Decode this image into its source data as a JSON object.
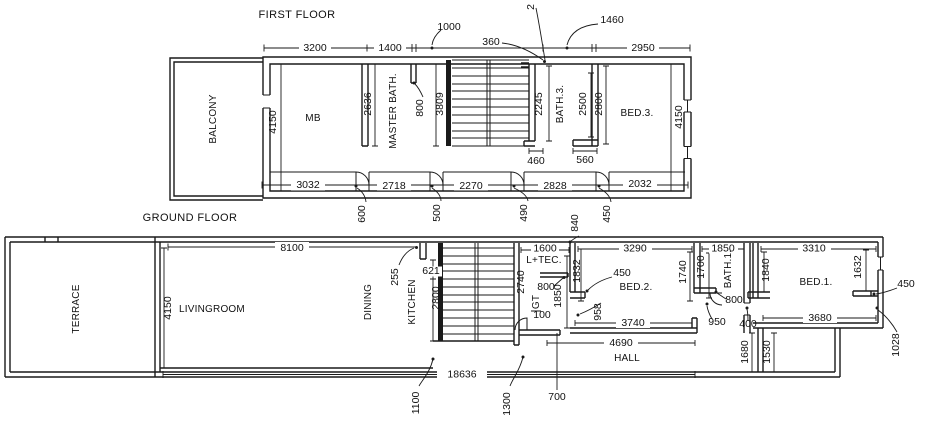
{
  "colors": {
    "line": "#1a1a1a",
    "background": "#ffffff"
  },
  "titles": {
    "first_floor": "FIRST FLOOR",
    "ground_floor": "GROUND FLOOR"
  },
  "first_floor": {
    "rooms": {
      "balcony": "BALCONY",
      "mb": "MB",
      "master_bath": "MASTER BATH.",
      "bath3": "BATH.3.",
      "bed3": "BED.3."
    },
    "dims": {
      "top_3200": "3200",
      "top_1400": "1400",
      "top_2950": "2950",
      "leader_1000": "1000",
      "leader_360": "360",
      "leader_1460": "1460",
      "leader_partial": "2",
      "left_4150": "4150",
      "mb_2636": "2636",
      "stub_800": "800",
      "stair_3809": "3809",
      "stair_2245": "2245",
      "bath3_2500": "2500",
      "bed3_2800": "2800",
      "right_4150": "4150",
      "bottom_3032": "3032",
      "bottom_2718": "2718",
      "bottom_2270": "2270",
      "bottom_2828": "2828",
      "bottom_2032": "2032",
      "door_460": "460",
      "door_560": "560",
      "below_600": "600",
      "below_500": "500",
      "below_490": "490",
      "below_840": "840",
      "below_450": "450"
    }
  },
  "ground_floor": {
    "rooms": {
      "terrace": "TERRACE",
      "livingroom": "LIVINGROOM",
      "dining": "DINING",
      "kitchen": "KITCHEN",
      "ltec": "L+TEC.",
      "gt": "GT",
      "bed2": "BED.2.",
      "bath1": "BATH.1.",
      "bed1": "BED.1.",
      "hall": "HALL"
    },
    "dims": {
      "living_8100": "8100",
      "living_4150": "4150",
      "leader_255": "255",
      "kitchen_621": "621",
      "kitchen_2800": "2800",
      "stair_2740": "2740",
      "ltec_1600": "1600",
      "ltec_800": "800",
      "ltec_1850": "1850",
      "ltec_1832": "1832",
      "gt_100": "100",
      "bed2_3290": "3290",
      "bed2_450": "450",
      "bed2_1740": "1740",
      "bed2_958": "958",
      "hall_3740": "3740",
      "hall_4690": "4690",
      "bath1_1850": "1850",
      "bath1_1700": "1700",
      "bath1_800": "800",
      "bath1_950": "950",
      "bath1_400": "400",
      "bed1_3310": "3310",
      "bed1_1840": "1840",
      "bed1_1632": "1632",
      "bed1_450": "450",
      "bed1_3680": "3680",
      "bed1_1028": "1028",
      "entry_1680": "1680",
      "entry_1530": "1530",
      "overall_18636": "18636",
      "below_1100": "1100",
      "below_1300": "1300",
      "below_700": "700"
    }
  }
}
